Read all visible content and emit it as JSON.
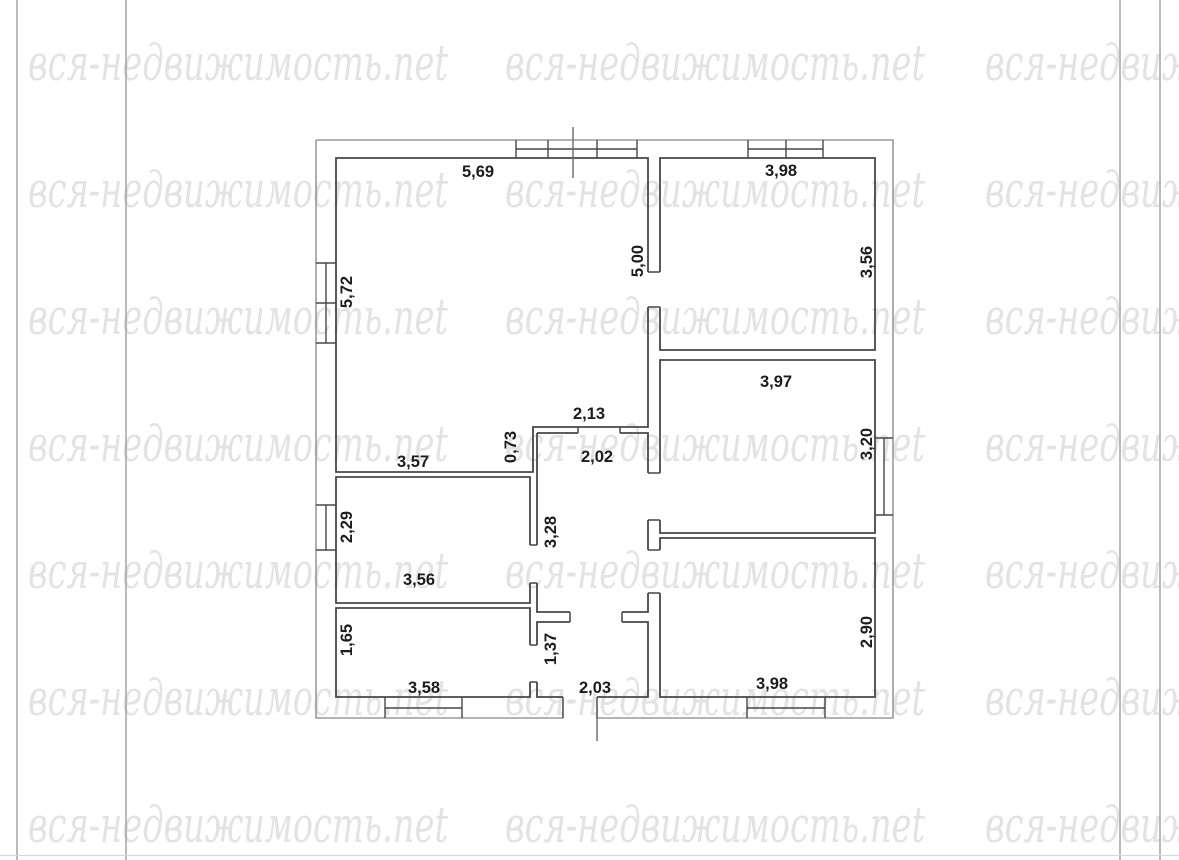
{
  "page": {
    "background": "#ffffff",
    "margin_line_color": "#a3a3a3"
  },
  "watermark": {
    "text": "вся-недвижимость.net",
    "color": "#e3e3e6"
  },
  "plan": {
    "wall_color": "#474747",
    "outer_wall_color": "#9a9a9a",
    "label_color": "#1c1c1c",
    "labels": [
      {
        "id": "living-top",
        "text": "5,69"
      },
      {
        "id": "bedroom1-top",
        "text": "3,98"
      },
      {
        "id": "living-left",
        "text": "5,72"
      },
      {
        "id": "living-right",
        "text": "5,00"
      },
      {
        "id": "bedroom1-right",
        "text": "3,56"
      },
      {
        "id": "bedroom2-top",
        "text": "3,97"
      },
      {
        "id": "hall-top-wall",
        "text": "2,13"
      },
      {
        "id": "step-wall",
        "text": "0,73"
      },
      {
        "id": "hall-width",
        "text": "2,02"
      },
      {
        "id": "living-bottom",
        "text": "3,57"
      },
      {
        "id": "bedroom2-right",
        "text": "3,20"
      },
      {
        "id": "kitchen-left",
        "text": "2,29"
      },
      {
        "id": "hall-height",
        "text": "3,28"
      },
      {
        "id": "kitchen-bottom",
        "text": "3,56"
      },
      {
        "id": "bedroom3-right",
        "text": "2,90"
      },
      {
        "id": "bath-left",
        "text": "1,65"
      },
      {
        "id": "vestibule-left",
        "text": "1,37"
      },
      {
        "id": "bath-bottom",
        "text": "3,58"
      },
      {
        "id": "vestibule-bottom",
        "text": "2,03"
      },
      {
        "id": "bedroom3-bottom",
        "text": "3,98"
      }
    ]
  }
}
